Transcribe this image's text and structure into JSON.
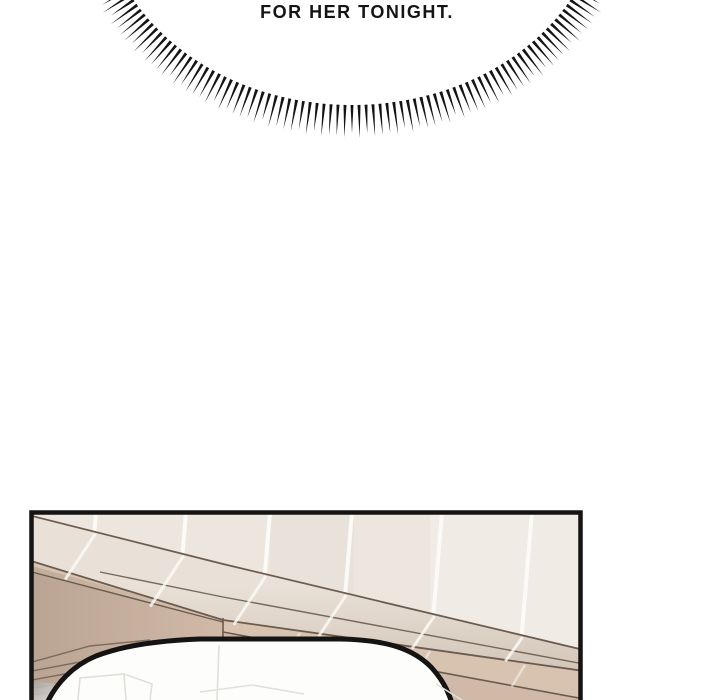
{
  "speech": {
    "text": "FOR HER TONIGHT."
  },
  "colors": {
    "ink": "#161412",
    "page_bg": "#FFFFFF",
    "wall": "#ECE6DE",
    "molding": "#E9E1D7",
    "tan": "#D8C2B0",
    "tan_deep": "#CFB8A6",
    "line_brown": "#6B5B4E",
    "tile_white": "#FCFBF8",
    "furniture_white": "#FDFDFC",
    "sketch_gray": "#E2DFDA",
    "corner_gray": "#B3AEAA"
  }
}
